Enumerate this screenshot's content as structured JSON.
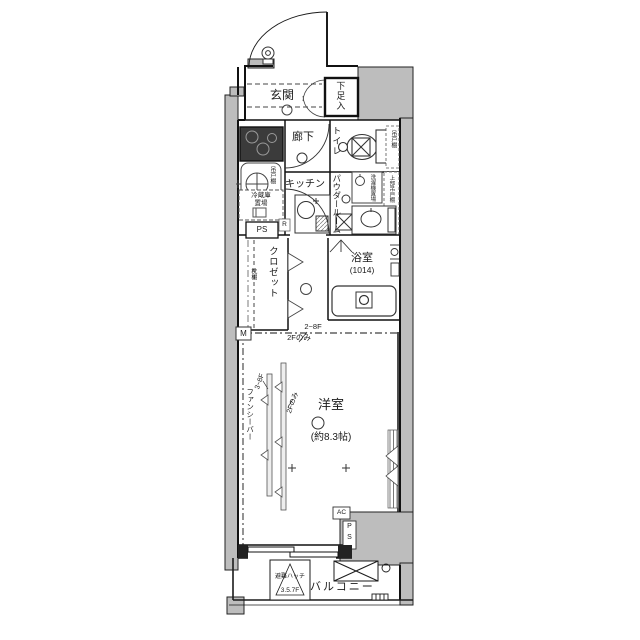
{
  "plan": {
    "entrance": {
      "label": "玄関"
    },
    "shoe_box": {
      "label": "下足入"
    },
    "hallway": {
      "label": "廊下"
    },
    "toilet": {
      "label": "トイレ",
      "cabinet": "吊戸棚"
    },
    "kitchen": {
      "label": "キッチン",
      "r_mark": "R"
    },
    "utility": {
      "washer_cabinet": "吊戸棚",
      "fridge_line1": "冷蔵庫",
      "fridge_line2": "置場",
      "ps": "PS"
    },
    "powder_room": {
      "label": "パウダールーム",
      "washer": "洗濯機置場",
      "upper_cabinet": "上部吊戸棚"
    },
    "bathroom": {
      "label": "浴室",
      "size": "(1014)"
    },
    "closet": {
      "label": "クロゼット",
      "shelf": "枕棚",
      "m_mark": "M"
    },
    "main_room": {
      "label": "洋室",
      "size": "(約8.3帖)",
      "fancy_bar": "ファンシーバー",
      "floors_2_8": "2~8F",
      "floor_2_only": "2Fのみ",
      "floors_3_8": "3~8F",
      "floor_2_only_b": "2Fのみ",
      "ac": "AC",
      "ps_p": "P",
      "ps_s": "S"
    },
    "balcony": {
      "label": "バルコニー",
      "hatch_line1": "避難ハッチ",
      "hatch_line2": "3.5.7F"
    }
  },
  "colors": {
    "wall": "#bdbdbd",
    "line": "#1b1b1b"
  }
}
